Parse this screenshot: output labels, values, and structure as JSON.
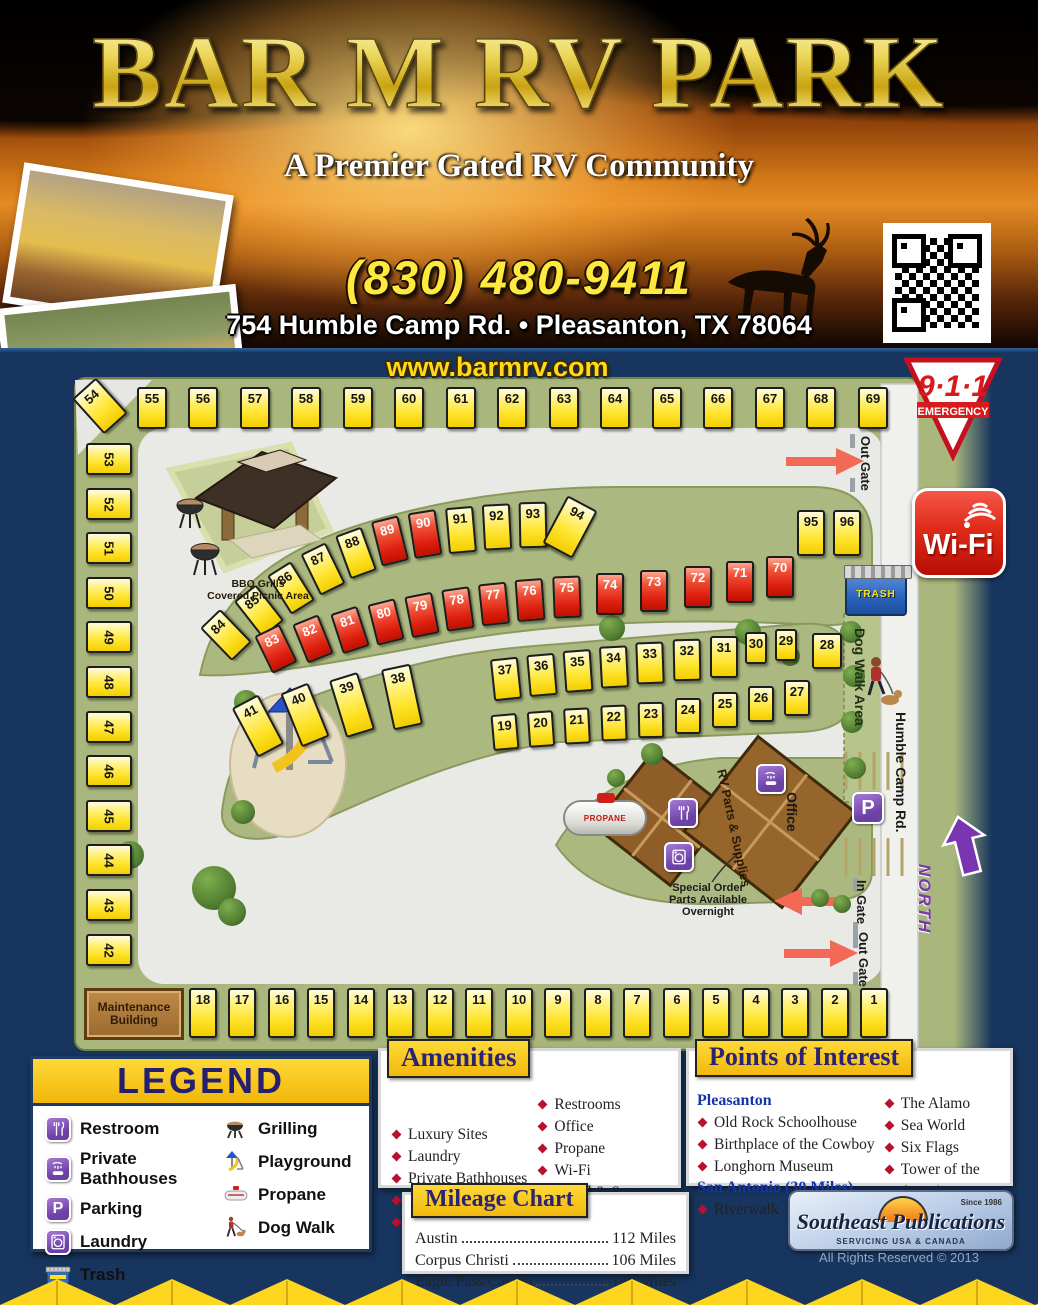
{
  "header": {
    "title": "BAR M RV PARK",
    "subtitle": "A Premier Gated RV Community",
    "phone": "(830) 480-9411",
    "address": "754 Humble Camp Rd. • Pleasanton, TX 78064",
    "website": "www.barmrv.com"
  },
  "badges": {
    "emergency_number": "9·1·1",
    "emergency_label": "EMERGENCY",
    "wifi": "Wi-Fi",
    "north": "NORTH"
  },
  "map": {
    "labels": {
      "out_gate_top": "Out Gate",
      "in_gate": "In Gate",
      "out_gate_bottom": "Out Gate",
      "dog_walk": "Dog Walk Area",
      "road": "Humble Camp Rd.",
      "bbq": "BBQ Grills\nCovered Picnic Area",
      "trash": "TRASH",
      "propane": "PROPANE",
      "office": "Office",
      "rv_parts": "RV Parts\n& Supplies",
      "special_order": "Special Order\nParts Available\nOvernight",
      "maintenance": "Maintenance\nBuilding"
    },
    "sites": [
      [
        55,
        137,
        387,
        30,
        42,
        0,
        0,
        0
      ],
      [
        56,
        188,
        387,
        30,
        42,
        0,
        0,
        0
      ],
      [
        57,
        240,
        387,
        30,
        42,
        0,
        0,
        0
      ],
      [
        58,
        291,
        387,
        30,
        42,
        0,
        0,
        0
      ],
      [
        59,
        343,
        387,
        30,
        42,
        0,
        0,
        0
      ],
      [
        60,
        394,
        387,
        30,
        42,
        0,
        0,
        0
      ],
      [
        61,
        446,
        387,
        30,
        42,
        0,
        0,
        0
      ],
      [
        62,
        497,
        387,
        30,
        42,
        0,
        0,
        0
      ],
      [
        63,
        549,
        387,
        30,
        42,
        0,
        0,
        0
      ],
      [
        64,
        600,
        387,
        30,
        42,
        0,
        0,
        0
      ],
      [
        65,
        652,
        387,
        30,
        42,
        0,
        0,
        0
      ],
      [
        66,
        703,
        387,
        30,
        42,
        0,
        0,
        0
      ],
      [
        67,
        755,
        387,
        30,
        42,
        0,
        0,
        0
      ],
      [
        68,
        806,
        387,
        30,
        42,
        0,
        0,
        0
      ],
      [
        69,
        858,
        387,
        30,
        42,
        0,
        0,
        0
      ],
      [
        54,
        84,
        382,
        32,
        48,
        -42,
        0,
        0
      ],
      [
        53,
        86,
        443,
        46,
        32,
        0,
        0,
        90
      ],
      [
        52,
        86,
        488,
        46,
        32,
        0,
        0,
        90
      ],
      [
        51,
        86,
        532,
        46,
        32,
        0,
        0,
        90
      ],
      [
        50,
        86,
        577,
        46,
        32,
        0,
        0,
        90
      ],
      [
        49,
        86,
        621,
        46,
        32,
        0,
        0,
        90
      ],
      [
        48,
        86,
        666,
        46,
        32,
        0,
        0,
        90
      ],
      [
        47,
        86,
        711,
        46,
        32,
        0,
        0,
        90
      ],
      [
        46,
        86,
        755,
        46,
        32,
        0,
        0,
        90
      ],
      [
        45,
        86,
        800,
        46,
        32,
        0,
        0,
        90
      ],
      [
        44,
        86,
        844,
        46,
        32,
        0,
        0,
        90
      ],
      [
        43,
        86,
        889,
        46,
        32,
        0,
        0,
        90
      ],
      [
        42,
        86,
        934,
        46,
        32,
        0,
        0,
        90
      ],
      [
        18,
        189,
        988,
        28,
        50,
        0,
        0,
        0
      ],
      [
        17,
        228,
        988,
        28,
        50,
        0,
        0,
        0
      ],
      [
        16,
        268,
        988,
        28,
        50,
        0,
        0,
        0
      ],
      [
        15,
        307,
        988,
        28,
        50,
        0,
        0,
        0
      ],
      [
        14,
        347,
        988,
        28,
        50,
        0,
        0,
        0
      ],
      [
        13,
        386,
        988,
        28,
        50,
        0,
        0,
        0
      ],
      [
        12,
        426,
        988,
        28,
        50,
        0,
        0,
        0
      ],
      [
        11,
        465,
        988,
        28,
        50,
        0,
        0,
        0
      ],
      [
        10,
        505,
        988,
        28,
        50,
        0,
        0,
        0
      ],
      [
        9,
        544,
        988,
        28,
        50,
        0,
        0,
        0
      ],
      [
        8,
        584,
        988,
        28,
        50,
        0,
        0,
        0
      ],
      [
        7,
        623,
        988,
        28,
        50,
        0,
        0,
        0
      ],
      [
        6,
        663,
        988,
        28,
        50,
        0,
        0,
        0
      ],
      [
        5,
        702,
        988,
        28,
        50,
        0,
        0,
        0
      ],
      [
        4,
        742,
        988,
        28,
        50,
        0,
        0,
        0
      ],
      [
        3,
        781,
        988,
        28,
        50,
        0,
        0,
        0
      ],
      [
        2,
        821,
        988,
        28,
        50,
        0,
        0,
        0
      ],
      [
        1,
        860,
        988,
        28,
        50,
        0,
        0,
        0
      ],
      [
        84,
        212,
        612,
        28,
        46,
        -44,
        0,
        0
      ],
      [
        85,
        245,
        588,
        28,
        46,
        -38,
        0,
        0
      ],
      [
        86,
        277,
        565,
        28,
        46,
        -32,
        0,
        0
      ],
      [
        87,
        309,
        546,
        28,
        46,
        -26,
        0,
        0
      ],
      [
        88,
        342,
        530,
        28,
        46,
        -20,
        0,
        0
      ],
      [
        89,
        376,
        518,
        28,
        46,
        -14,
        1,
        0
      ],
      [
        90,
        411,
        511,
        28,
        46,
        -9,
        1,
        0
      ],
      [
        91,
        447,
        507,
        28,
        46,
        -5,
        0,
        0
      ],
      [
        92,
        483,
        504,
        28,
        46,
        -3,
        0,
        0
      ],
      [
        93,
        519,
        502,
        28,
        46,
        -1,
        0,
        0
      ],
      [
        94,
        553,
        500,
        34,
        54,
        28,
        0,
        0
      ],
      [
        95,
        797,
        510,
        28,
        46,
        0,
        0,
        0
      ],
      [
        96,
        833,
        510,
        28,
        46,
        0,
        0,
        0
      ],
      [
        83,
        262,
        628,
        28,
        42,
        -26,
        1,
        0
      ],
      [
        82,
        299,
        618,
        28,
        42,
        -22,
        1,
        0
      ],
      [
        81,
        336,
        609,
        28,
        42,
        -18,
        1,
        0
      ],
      [
        80,
        372,
        601,
        28,
        42,
        -14,
        1,
        0
      ],
      [
        79,
        408,
        594,
        28,
        42,
        -11,
        1,
        0
      ],
      [
        78,
        444,
        588,
        28,
        42,
        -8,
        1,
        0
      ],
      [
        77,
        480,
        583,
        28,
        42,
        -6,
        1,
        0
      ],
      [
        76,
        516,
        579,
        28,
        42,
        -4,
        1,
        0
      ],
      [
        75,
        553,
        576,
        28,
        42,
        -2,
        1,
        0
      ],
      [
        74,
        596,
        573,
        28,
        42,
        0,
        1,
        0
      ],
      [
        73,
        640,
        570,
        28,
        42,
        0,
        1,
        0
      ],
      [
        72,
        684,
        566,
        28,
        42,
        0,
        1,
        0
      ],
      [
        71,
        726,
        561,
        28,
        42,
        0,
        1,
        0
      ],
      [
        70,
        766,
        556,
        28,
        42,
        0,
        1,
        0
      ],
      [
        41,
        243,
        698,
        30,
        56,
        -28,
        0,
        0
      ],
      [
        40,
        290,
        686,
        30,
        58,
        -22,
        0,
        0
      ],
      [
        39,
        337,
        675,
        30,
        60,
        -17,
        0,
        0
      ],
      [
        38,
        387,
        666,
        30,
        62,
        -12,
        0,
        0
      ],
      [
        37,
        492,
        658,
        28,
        42,
        -6,
        0,
        0
      ],
      [
        36,
        528,
        654,
        28,
        42,
        -5,
        0,
        0
      ],
      [
        35,
        564,
        650,
        28,
        42,
        -4,
        0,
        0
      ],
      [
        34,
        600,
        646,
        28,
        42,
        -3,
        0,
        0
      ],
      [
        33,
        636,
        642,
        28,
        42,
        -2,
        0,
        0
      ],
      [
        32,
        673,
        639,
        28,
        42,
        -1,
        0,
        0
      ],
      [
        31,
        710,
        636,
        28,
        42,
        0,
        0,
        0
      ],
      [
        30,
        745,
        632,
        22,
        32,
        0,
        0,
        0
      ],
      [
        29,
        775,
        629,
        22,
        32,
        0,
        0,
        0
      ],
      [
        28,
        812,
        633,
        30,
        36,
        0,
        0,
        0
      ],
      [
        19,
        492,
        714,
        26,
        36,
        -5,
        0,
        0
      ],
      [
        20,
        528,
        711,
        26,
        36,
        -4,
        0,
        0
      ],
      [
        21,
        564,
        708,
        26,
        36,
        -3,
        0,
        0
      ],
      [
        22,
        601,
        705,
        26,
        36,
        -2,
        0,
        0
      ],
      [
        23,
        638,
        702,
        26,
        36,
        -1,
        0,
        0
      ],
      [
        24,
        675,
        698,
        26,
        36,
        0,
        0,
        0
      ],
      [
        25,
        712,
        692,
        26,
        36,
        0,
        0,
        0
      ],
      [
        26,
        748,
        686,
        26,
        36,
        0,
        0,
        0
      ],
      [
        27,
        784,
        680,
        26,
        36,
        0,
        0,
        0
      ]
    ]
  },
  "legend": {
    "title": "LEGEND",
    "col1": [
      {
        "icon": "restroom",
        "label": "Restroom"
      },
      {
        "icon": "bathhouse",
        "label": "Private Bathhouses"
      },
      {
        "icon": "parking",
        "label": "Parking"
      },
      {
        "icon": "laundry",
        "label": "Laundry"
      },
      {
        "icon": "trash",
        "label": "Trash"
      }
    ],
    "col2": [
      {
        "icon": "grill",
        "label": "Grilling"
      },
      {
        "icon": "playground",
        "label": "Playground"
      },
      {
        "icon": "propane",
        "label": "Propane"
      },
      {
        "icon": "dogwalk",
        "label": "Dog Walk"
      }
    ]
  },
  "amenities": {
    "title": "Amenities",
    "col1": [
      "Luxury Sites",
      "Laundry",
      "Private Bathhouses",
      "Grilling",
      "Dog Walk"
    ],
    "col2": [
      "Restrooms",
      "Office",
      "Propane",
      "Wi-Fi",
      "Gated & Secure",
      "Level Sites",
      "RV Parts & Supplies"
    ]
  },
  "poi": {
    "title": "Points of Interest",
    "groups": [
      {
        "heading": "Pleasanton",
        "items": [
          "Old Rock Schoolhouse",
          "Birthplace of the Cowboy",
          "Longhorn Museum"
        ]
      },
      {
        "heading": "San Antonio (30 Miles)",
        "items": [
          "Riverwalk"
        ]
      }
    ],
    "col2": [
      "The Alamo",
      "Sea World",
      "Six Flags",
      "Tower of the Americas",
      "Zoo & Aquarium"
    ]
  },
  "mileage": {
    "title": "Mileage Chart",
    "rows": [
      {
        "place": "Austin",
        "miles": "112 Miles"
      },
      {
        "place": "Corpus Christi",
        "miles": "106 Miles"
      },
      {
        "place": "Eagle Pass Casino",
        "miles": "140 Miles"
      }
    ]
  },
  "publisher": {
    "name": "Southeast Publications",
    "since": "Since 1986",
    "tagline": "SERVICING USA & CANADA",
    "rights": "All Rights Reserved © 2013"
  },
  "colors": {
    "navy": "#17355e",
    "map_green": "#a9b77d",
    "road_gray": "#e9e9e6",
    "site_yellow": "#ffe32b",
    "site_red": "#de2110",
    "accent_yellow": "#f2b90c",
    "icon_purple": "#6c41a4",
    "badge_red": "#d81a1a",
    "poi_blue": "#1534a8"
  }
}
